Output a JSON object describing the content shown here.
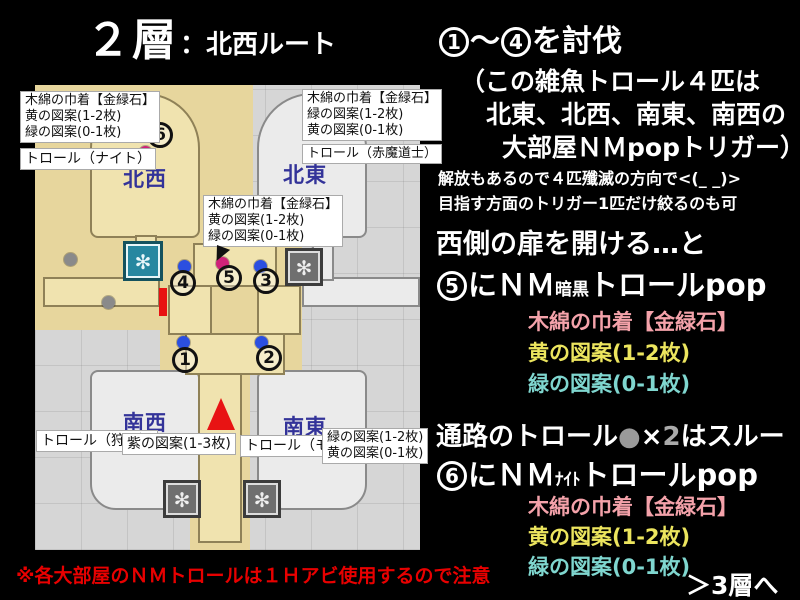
{
  "title": {
    "floor": "２層",
    "route": "：北西ルート"
  },
  "map": {
    "regions": {
      "nw": "北西",
      "ne": "北東",
      "sw": "南西",
      "se": "南東"
    },
    "markers": {
      "m1": "1",
      "m2": "2",
      "m3": "3",
      "m4": "4",
      "m5": "5",
      "m6": "6"
    },
    "boxes": {
      "nw_items": [
        "木綿の巾着【金緑石】",
        "黄の図案(1-2枚)",
        "緑の図案(0-1枚)"
      ],
      "nw_troll": "トロール（ナイト）",
      "ne_items": [
        "木綿の巾着【金緑石】",
        "緑の図案(1-2枚)",
        "黄の図案(0-1枚)"
      ],
      "ne_troll": "トロール（赤魔道士）",
      "center_items": [
        "木綿の巾着【金緑石】",
        "黄の図案(1-2枚)",
        "緑の図案(0-1枚)"
      ],
      "sw_troll": "トロール（狩人）",
      "sw_pattern": "紫の図案(1-3枚)",
      "se_troll": "トロール（モンク）",
      "se_items": [
        "緑の図案(1-2枚)",
        "黄の図案(0-1枚)"
      ]
    }
  },
  "right": {
    "h1": {
      "n1": "1",
      "t1": "～",
      "n2": "4",
      "t2": "を討伐"
    },
    "p1": "（この雑魚トロール４匹は",
    "p2": "北東、北西、南東、南西の",
    "p3": "大部屋ＮＭpopトリガー）",
    "s1": "解放もあるので４匹殲滅の方向で<(_ _)>",
    "s2": "目指す方面のトリガー1匹だけ絞るのも可",
    "h2": "西側の扉を開ける…と",
    "h3": {
      "n": "5",
      "t1": "にＮＭ",
      "small": "暗黒",
      "t2": "トロールpop"
    },
    "drops5": {
      "bag": "木綿の巾着【金緑石】",
      "yellow": "黄の図案(1-2枚)",
      "green": "緑の図案(0-1枚)"
    },
    "h4": {
      "t1": "通路のトロール",
      "dot": "●",
      "x": "×",
      "n": "2",
      "t2": "はスルー"
    },
    "h5": {
      "n": "6",
      "t1": "にＮＭ",
      "small": "ﾅｲﾄ",
      "t2": "トロールpop"
    },
    "drops6": {
      "bag": "木綿の巾着【金緑石】",
      "yellow": "黄の図案(1-2枚)",
      "green": "緑の図案(0-1枚)"
    },
    "next": "＞3層へ"
  },
  "footer": {
    "warning": "※各大部屋のＮＭトロールは１Ｈアビ使用するので注意"
  },
  "colors": {
    "background": "#000000",
    "map_gray": "#d6d6d6",
    "map_tan": "#e7d69d",
    "drop_pink": "#f4a2aa",
    "drop_yellow": "#ece55e",
    "drop_green": "#7fd6cf",
    "warning_red": "#e80000",
    "region_blue": "#333399",
    "marker_pink": "#cf2179",
    "marker_blue": "#2b4fe0",
    "marker_gray": "#8a8a8a",
    "door_red": "#e81212"
  }
}
